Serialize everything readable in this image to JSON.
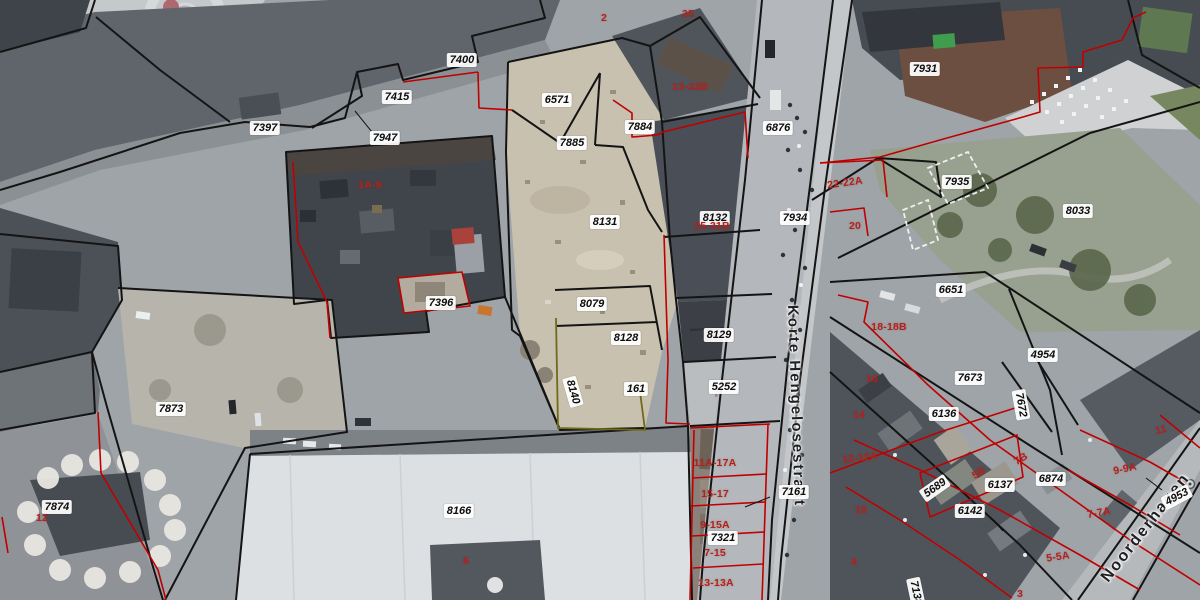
{
  "map": {
    "street_labels": [
      {
        "name": "Korte Hengelosestraat",
        "x": 796,
        "y": 406,
        "rotation": 88,
        "size": 15
      },
      {
        "name": "Noorderhagen",
        "x": 1146,
        "y": 528,
        "rotation": -52,
        "size": 16
      }
    ],
    "parcel_labels": [
      {
        "text": "7400",
        "x": 462,
        "y": 60
      },
      {
        "text": "7415",
        "x": 397,
        "y": 97
      },
      {
        "text": "7397",
        "x": 265,
        "y": 128
      },
      {
        "text": "7947",
        "x": 385,
        "y": 138
      },
      {
        "text": "6571",
        "x": 557,
        "y": 100
      },
      {
        "text": "7884",
        "x": 640,
        "y": 127
      },
      {
        "text": "7885",
        "x": 572,
        "y": 143
      },
      {
        "text": "6876",
        "x": 778,
        "y": 128
      },
      {
        "text": "7931",
        "x": 925,
        "y": 69
      },
      {
        "text": "7935",
        "x": 957,
        "y": 182
      },
      {
        "text": "8033",
        "x": 1078,
        "y": 211
      },
      {
        "text": "7934",
        "x": 795,
        "y": 218
      },
      {
        "text": "8131",
        "x": 605,
        "y": 222
      },
      {
        "text": "8132",
        "x": 715,
        "y": 218
      },
      {
        "text": "6651",
        "x": 951,
        "y": 290
      },
      {
        "text": "8079",
        "x": 592,
        "y": 304
      },
      {
        "text": "7396",
        "x": 441,
        "y": 303
      },
      {
        "text": "8129",
        "x": 719,
        "y": 335
      },
      {
        "text": "8128",
        "x": 626,
        "y": 338
      },
      {
        "text": "4954",
        "x": 1043,
        "y": 355
      },
      {
        "text": "7673",
        "x": 970,
        "y": 378
      },
      {
        "text": "161",
        "x": 636,
        "y": 389
      },
      {
        "text": "5252",
        "x": 724,
        "y": 387
      },
      {
        "text": "8140",
        "x": 573,
        "y": 392,
        "rotation": 74
      },
      {
        "text": "7672",
        "x": 1021,
        "y": 405,
        "rotation": 80
      },
      {
        "text": "7873",
        "x": 171,
        "y": 409
      },
      {
        "text": "6136",
        "x": 944,
        "y": 414
      },
      {
        "text": "7874",
        "x": 57,
        "y": 507
      },
      {
        "text": "8166",
        "x": 459,
        "y": 511
      },
      {
        "text": "7161",
        "x": 794,
        "y": 492
      },
      {
        "text": "6137",
        "x": 1000,
        "y": 485
      },
      {
        "text": "6874",
        "x": 1051,
        "y": 479
      },
      {
        "text": "6142",
        "x": 970,
        "y": 511
      },
      {
        "text": "5689",
        "x": 935,
        "y": 488,
        "rotation": -35
      },
      {
        "text": "4953",
        "x": 1177,
        "y": 497,
        "rotation": -28
      },
      {
        "text": "7321",
        "x": 723,
        "y": 538
      },
      {
        "text": "7138",
        "x": 916,
        "y": 593,
        "rotation": 78
      }
    ],
    "address_labels": [
      {
        "text": "1A-9",
        "x": 370,
        "y": 185
      },
      {
        "text": "2",
        "x": 604,
        "y": 18
      },
      {
        "text": "35",
        "x": 688,
        "y": 14
      },
      {
        "text": "13-33B",
        "x": 690,
        "y": 87
      },
      {
        "text": "25-31B",
        "x": 712,
        "y": 226
      },
      {
        "text": "22-22A",
        "x": 845,
        "y": 183,
        "rotation": -8
      },
      {
        "text": "20",
        "x": 855,
        "y": 226
      },
      {
        "text": "18-18B",
        "x": 889,
        "y": 327
      },
      {
        "text": "16",
        "x": 872,
        "y": 379
      },
      {
        "text": "14",
        "x": 859,
        "y": 415
      },
      {
        "text": "12-12A",
        "x": 860,
        "y": 458,
        "rotation": -6
      },
      {
        "text": "10",
        "x": 861,
        "y": 510
      },
      {
        "text": "4",
        "x": 854,
        "y": 562
      },
      {
        "text": "12",
        "x": 42,
        "y": 518
      },
      {
        "text": "6",
        "x": 466,
        "y": 561
      },
      {
        "text": "11A-17A",
        "x": 715,
        "y": 463
      },
      {
        "text": "15-17",
        "x": 715,
        "y": 494
      },
      {
        "text": "9-15A",
        "x": 715,
        "y": 525
      },
      {
        "text": "7-15",
        "x": 715,
        "y": 553
      },
      {
        "text": "13-13A",
        "x": 716,
        "y": 583
      },
      {
        "text": "7B",
        "x": 1021,
        "y": 459,
        "rotation": -32
      },
      {
        "text": "5B",
        "x": 979,
        "y": 473,
        "rotation": -32
      },
      {
        "text": "9-9A",
        "x": 1125,
        "y": 469,
        "rotation": -12
      },
      {
        "text": "7-7A",
        "x": 1099,
        "y": 513,
        "rotation": -10
      },
      {
        "text": "5-5A",
        "x": 1058,
        "y": 557,
        "rotation": -8
      },
      {
        "text": "11",
        "x": 1161,
        "y": 430,
        "rotation": -14
      },
      {
        "text": "3",
        "x": 1020,
        "y": 594
      }
    ],
    "colors": {
      "parcel_boundary": "#141414",
      "municipal_red_boundary": "#c00000",
      "address_text": "#b5201a",
      "label_background": "#ffffff",
      "label_text": "#0d0d0d",
      "special_boundary_olive": "#6f6a1a",
      "selection_dashed_white": "#fafafa",
      "construction_site": "#c9c1b0",
      "road_surface": "#b4b7bb",
      "building_dark": "#42474e",
      "big_roof_light": "#dde0e2",
      "vegetation": "#98a08f"
    }
  }
}
